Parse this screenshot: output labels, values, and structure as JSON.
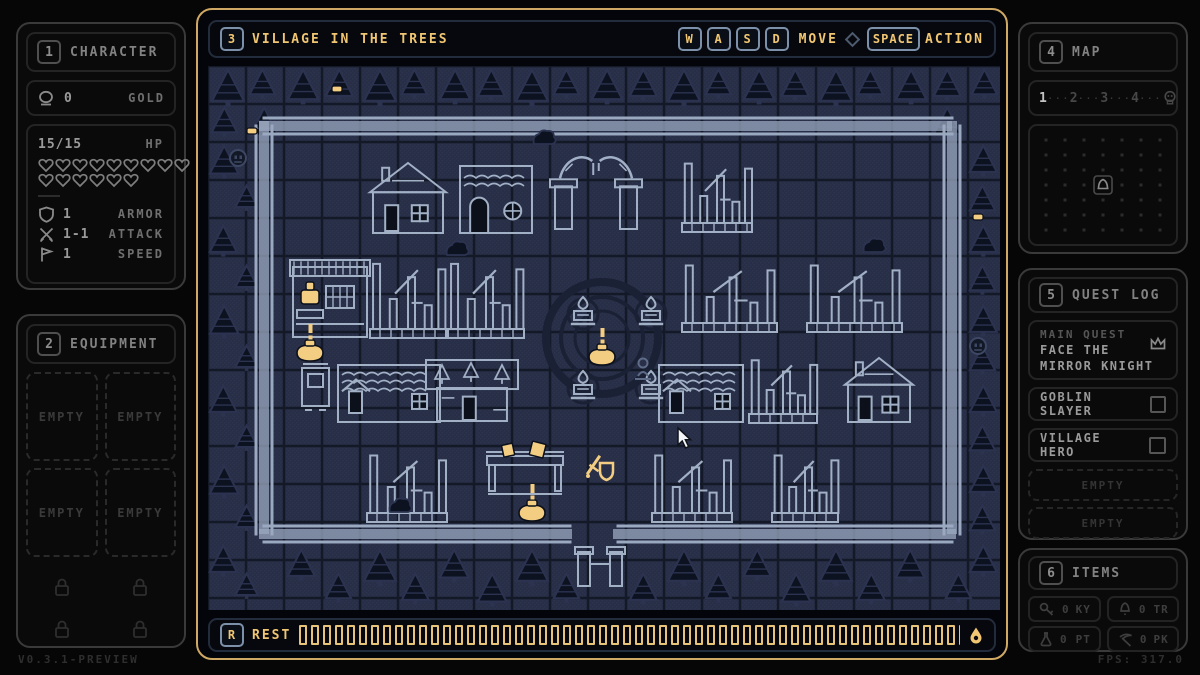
{
  "app": {
    "version": "V0.3.1-PREVIEW",
    "fps": "FPS: 317.0"
  },
  "colors": {
    "accent": "#f1c672",
    "gold": "#f3cd82",
    "wall": "#9aa8c0",
    "light": "#a2b0c6",
    "map_bg": "#272e46",
    "map_grid": "#141928",
    "map_dither": "#2f3752",
    "tree_fill": "#0d1220",
    "tree_stroke": "#2b3350",
    "dark_detail": "#1a2135",
    "cursor": "#f4f6f8"
  },
  "character": {
    "key": "1",
    "title": "CHARACTER",
    "gold_value": "0",
    "gold_label": "GOLD",
    "hp_value": "15/15",
    "hp_label": "HP",
    "hearts_total": 15,
    "stats": [
      {
        "icon": "shield-icon",
        "value": "1",
        "label": "ARMOR"
      },
      {
        "icon": "swords-icon",
        "value": "1-1",
        "label": "ATTACK"
      },
      {
        "icon": "flag-icon",
        "value": "1",
        "label": "SPEED"
      }
    ]
  },
  "equipment": {
    "key": "2",
    "title": "EQUIPMENT",
    "slots": [
      "EMPTY",
      "EMPTY",
      "EMPTY",
      "EMPTY"
    ],
    "locked_slots": 4
  },
  "level": {
    "key": "3",
    "title": "VILLAGE IN THE TREES",
    "controls": {
      "move_keys": [
        "W",
        "A",
        "S",
        "D"
      ],
      "move_label": "MOVE",
      "action_key": "SPACE",
      "action_label": "ACTION"
    }
  },
  "map_panel": {
    "key": "4",
    "title": "MAP",
    "steps": [
      {
        "label": "1",
        "active": true
      },
      {
        "label": "2",
        "active": false
      },
      {
        "label": "3",
        "active": false
      },
      {
        "label": "4",
        "active": false
      }
    ],
    "separator": "···",
    "end_icon": "skull-icon",
    "grid": {
      "cols": 7,
      "rows": 7
    },
    "marker": "camp-icon"
  },
  "quest_log": {
    "key": "5",
    "title": "QUEST LOG",
    "main_quest": {
      "tag": "MAIN QUEST",
      "name_line1": "FACE THE",
      "name_line2": "MIRROR KNIGHT",
      "icon": "crown-icon"
    },
    "quests": [
      {
        "name": "GOBLIN SLAYER"
      },
      {
        "name": "VILLAGE HERO"
      }
    ],
    "empty_slots": [
      "EMPTY",
      "EMPTY"
    ]
  },
  "items": {
    "key": "6",
    "title": "ITEMS",
    "slots": [
      {
        "icon": "key-icon",
        "count": "0",
        "code": "KY"
      },
      {
        "icon": "bell-icon",
        "count": "0",
        "code": "TR"
      },
      {
        "icon": "potion-icon",
        "count": "0",
        "code": "PT"
      },
      {
        "icon": "pickaxe-icon",
        "count": "0",
        "code": "PK"
      }
    ]
  },
  "rest_bar": {
    "key": "R",
    "label": "REST",
    "segments": 57,
    "end_icon": "droplet-icon"
  },
  "village_map": {
    "tile": 38,
    "width": 792,
    "height": 544,
    "wall_segments": [
      [
        56,
        60,
        744,
        60
      ],
      [
        56,
        60,
        56,
        468
      ],
      [
        744,
        60,
        744,
        468
      ],
      [
        56,
        468,
        362,
        468
      ],
      [
        410,
        468,
        744,
        468
      ]
    ],
    "trees": [
      [
        2,
        2,
        1
      ],
      [
        40,
        2,
        0.8
      ],
      [
        78,
        2,
        0.95
      ],
      [
        116,
        2,
        0.85
      ],
      [
        154,
        2,
        1
      ],
      [
        192,
        2,
        0.8
      ],
      [
        230,
        2,
        0.95
      ],
      [
        268,
        2,
        0.85
      ],
      [
        306,
        2,
        1
      ],
      [
        344,
        2,
        0.8
      ],
      [
        382,
        2,
        0.95
      ],
      [
        420,
        2,
        0.85
      ],
      [
        458,
        2,
        1
      ],
      [
        496,
        2,
        0.8
      ],
      [
        534,
        2,
        0.95
      ],
      [
        572,
        2,
        0.85
      ],
      [
        610,
        2,
        1
      ],
      [
        648,
        2,
        0.8
      ],
      [
        686,
        2,
        0.95
      ],
      [
        724,
        2,
        0.85
      ],
      [
        762,
        2,
        0.8
      ],
      [
        2,
        40,
        0.8
      ],
      [
        40,
        40,
        0.9
      ],
      [
        724,
        40,
        0.85
      ],
      [
        0,
        78,
        0.9
      ],
      [
        26,
        118,
        0.7
      ],
      [
        0,
        158,
        0.85
      ],
      [
        26,
        198,
        0.7
      ],
      [
        0,
        238,
        0.9
      ],
      [
        26,
        278,
        0.7
      ],
      [
        0,
        318,
        0.85
      ],
      [
        26,
        358,
        0.7
      ],
      [
        0,
        398,
        0.9
      ],
      [
        26,
        438,
        0.7
      ],
      [
        0,
        478,
        0.85
      ],
      [
        26,
        506,
        0.7
      ],
      [
        760,
        78,
        0.85
      ],
      [
        760,
        118,
        0.8
      ],
      [
        760,
        158,
        0.85
      ],
      [
        760,
        198,
        0.8
      ],
      [
        760,
        238,
        0.85
      ],
      [
        760,
        278,
        0.8
      ],
      [
        760,
        318,
        0.85
      ],
      [
        760,
        358,
        0.8
      ],
      [
        760,
        398,
        0.85
      ],
      [
        760,
        438,
        0.8
      ],
      [
        760,
        478,
        0.85
      ],
      [
        736,
        506,
        0.8
      ],
      [
        78,
        482,
        0.85
      ],
      [
        154,
        482,
        1
      ],
      [
        230,
        482,
        0.9
      ],
      [
        306,
        482,
        1
      ],
      [
        458,
        482,
        1
      ],
      [
        534,
        482,
        0.85
      ],
      [
        610,
        482,
        1
      ],
      [
        686,
        482,
        0.9
      ],
      [
        116,
        506,
        0.8
      ],
      [
        192,
        506,
        0.85
      ],
      [
        268,
        506,
        0.9
      ],
      [
        344,
        506,
        0.8
      ],
      [
        420,
        506,
        0.85
      ],
      [
        496,
        506,
        0.8
      ],
      [
        572,
        506,
        0.9
      ],
      [
        648,
        506,
        0.85
      ]
    ],
    "features": [
      [
        "plaza",
        394,
        272
      ],
      [
        "house",
        162,
        96,
        76,
        72
      ],
      [
        "roundhouse",
        250,
        96,
        76,
        72
      ],
      [
        "arch",
        342,
        86,
        92,
        78
      ],
      [
        "ruin",
        474,
        94,
        70,
        72
      ],
      [
        "shop",
        84,
        194,
        76,
        78
      ],
      [
        "ruin",
        162,
        194,
        76,
        78
      ],
      [
        "ruin",
        240,
        194,
        76,
        78
      ],
      [
        "ruin",
        474,
        196,
        95,
        70
      ],
      [
        "ruin",
        599,
        196,
        95,
        70
      ],
      [
        "brazier",
        362,
        232
      ],
      [
        "brazier",
        430,
        232
      ],
      [
        "brazier",
        362,
        306
      ],
      [
        "brazier",
        430,
        306
      ],
      [
        "npc",
        394,
        276
      ],
      [
        "npc",
        102,
        272
      ],
      [
        "shrine",
        94,
        296
      ],
      [
        "wavehouse",
        128,
        291,
        106,
        66
      ],
      [
        "gardenhouse",
        218,
        291,
        92,
        66
      ],
      [
        "wavehouse",
        449,
        291,
        88,
        66
      ],
      [
        "ruin",
        541,
        291,
        68,
        66
      ],
      [
        "house",
        637,
        291,
        68,
        66
      ],
      [
        "statue",
        428,
        292
      ],
      [
        "ruin",
        159,
        386,
        80,
        70
      ],
      [
        "stall",
        279,
        384,
        76,
        50
      ],
      [
        "npc",
        324,
        432
      ],
      [
        "swordshield",
        378,
        386
      ],
      [
        "ruin",
        444,
        386,
        80,
        70
      ],
      [
        "ruin",
        564,
        386,
        66,
        70
      ],
      [
        "gatehouse",
        370,
        478
      ],
      [
        "coin",
        39,
        62
      ],
      [
        "coin",
        124,
        20
      ],
      [
        "coin",
        765,
        148
      ],
      [
        "gargoyle",
        22,
        84
      ],
      [
        "gargoyle",
        762,
        272
      ],
      [
        "bush",
        237,
        175
      ],
      [
        "bush",
        324,
        64
      ],
      [
        "bush",
        654,
        172
      ],
      [
        "bush",
        180,
        432
      ]
    ],
    "cursor": {
      "x": 470,
      "y": 362
    }
  }
}
